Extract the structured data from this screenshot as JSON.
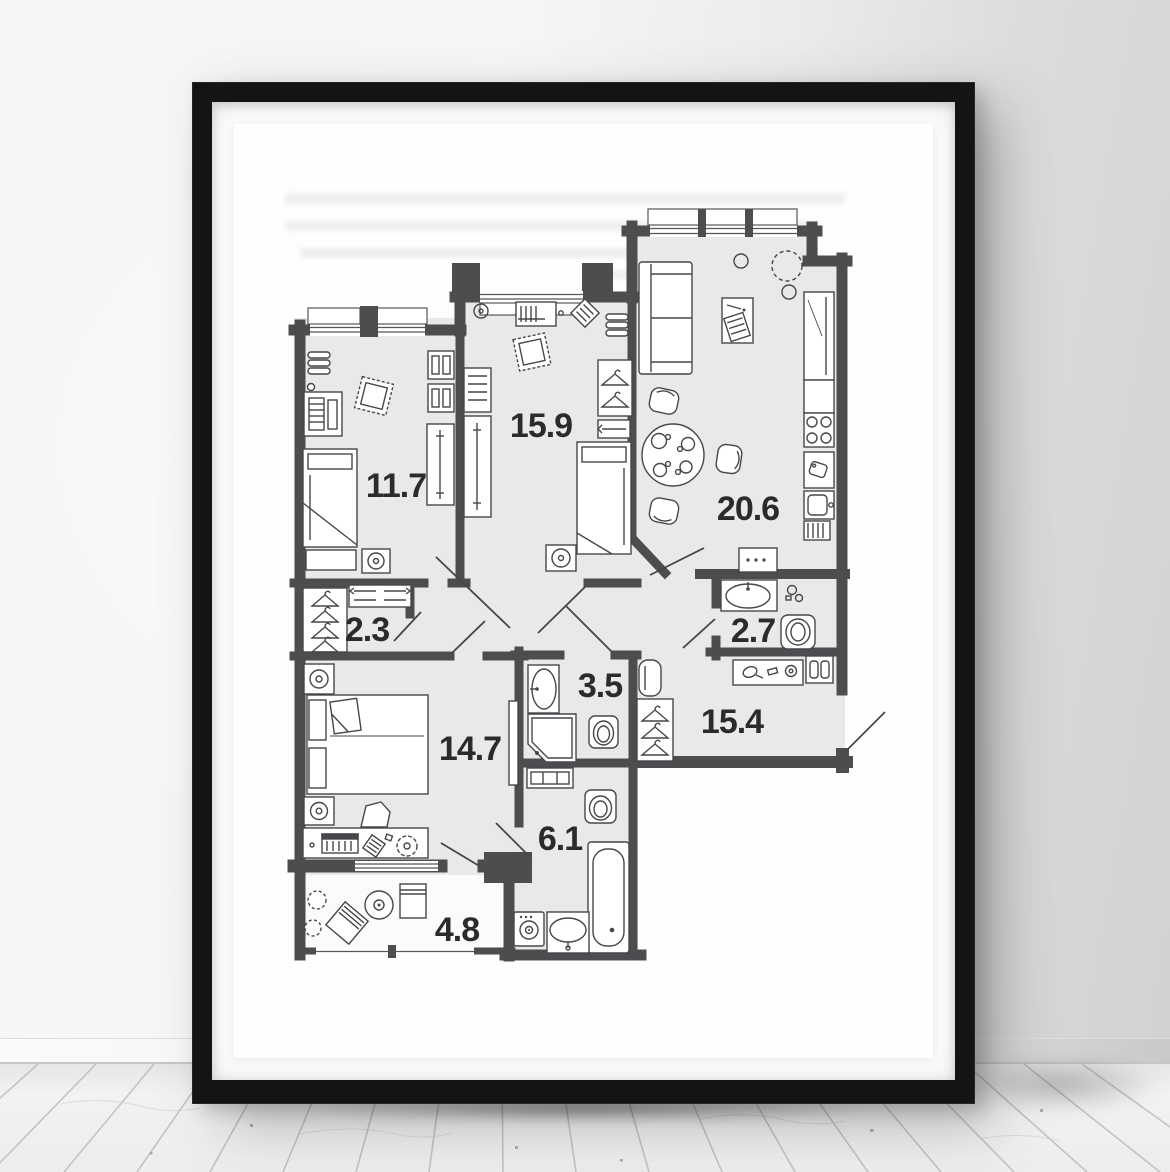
{
  "scene": {
    "description": "black framed apartment floor-plan poster leaning against a wall on a white wooden plank floor",
    "frame_color": "#141414",
    "mat_color": "#fcfcfc",
    "wall_color_left": "#f5f5f4",
    "wall_color_right": "#d2d2d1",
    "floor_plank_color": "#efefee",
    "plank_line_color": "#b4b4b2"
  },
  "floor_plan": {
    "wall_color": "#4d4d4f",
    "room_fill": "#e9e9ea",
    "furniture_line_color": "#47474b",
    "label_color": "#2b2b2e",
    "rooms": [
      {
        "id": "bedroom-top-left",
        "label": "11.7"
      },
      {
        "id": "bedroom-top-middle",
        "label": "15.9"
      },
      {
        "id": "kitchen-living-room",
        "label": "20.6"
      },
      {
        "id": "closet",
        "label": "2.3"
      },
      {
        "id": "wc",
        "label": "2.7"
      },
      {
        "id": "shower-room",
        "label": "3.5"
      },
      {
        "id": "hallway",
        "label": "15.4"
      },
      {
        "id": "bedroom-bottom-left",
        "label": "14.7"
      },
      {
        "id": "bathroom",
        "label": "6.1"
      },
      {
        "id": "balcony",
        "label": "4.8"
      }
    ],
    "furniture_icons": [
      "single-bed-icon",
      "double-bed-icon",
      "wardrobe-icon",
      "sliding-wardrobe-icon",
      "hanger-icon",
      "shelf-icon",
      "desk-icon",
      "pouf-icon",
      "sofa-icon",
      "tv-unit-icon",
      "dining-table-icon",
      "chair-icon",
      "fridge-icon",
      "stove-icon",
      "kitchen-sink-icon",
      "cutting-board-icon",
      "vent-icon",
      "lamp-icon",
      "wash-basin-icon",
      "toilet-icon",
      "shower-cabin-icon",
      "bathtub-icon",
      "washing-machine-icon",
      "mirror-icon",
      "console-icon",
      "plant-icon",
      "door-swing-icon",
      "window-icon"
    ]
  }
}
